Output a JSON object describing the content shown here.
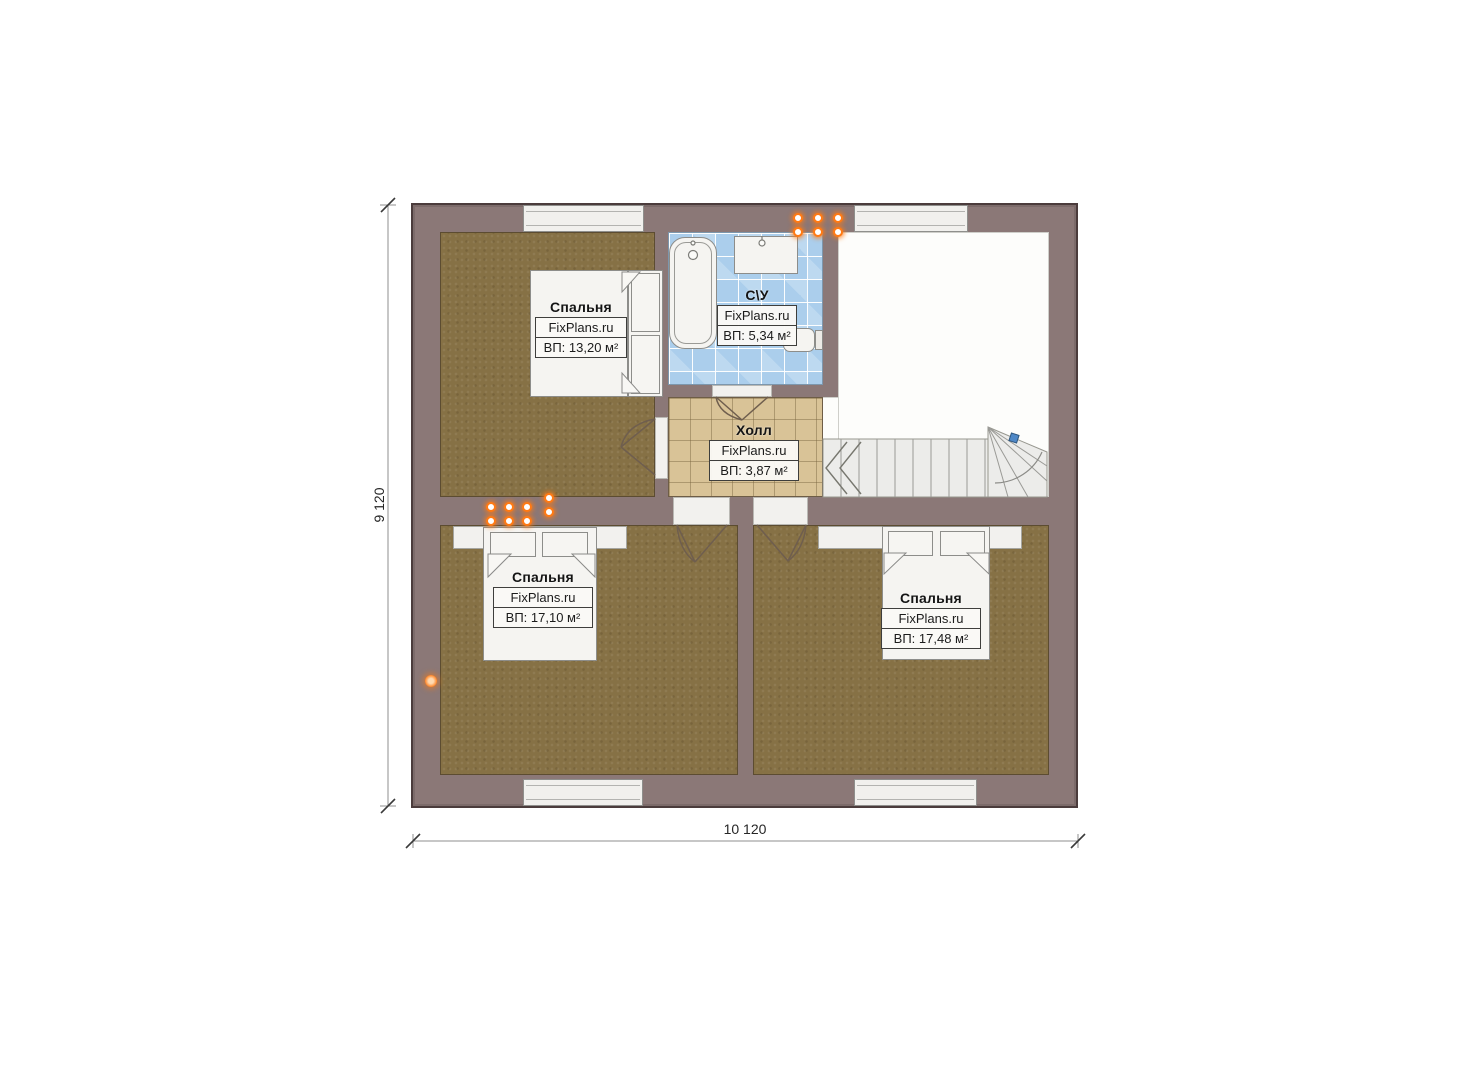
{
  "plan": {
    "dimensions": {
      "height_label": "9 120",
      "width_label": "10 120"
    },
    "rooms": {
      "bedroom_top_left": {
        "name": "Спальня",
        "brand": "FixPlans.ru",
        "area": "ВП: 13,20 м²"
      },
      "bathroom": {
        "name": "С\\У",
        "brand": "FixPlans.ru",
        "area": "ВП: 5,34 м²"
      },
      "hall": {
        "name": "Холл",
        "brand": "FixPlans.ru",
        "area": "ВП: 3,87 м²"
      },
      "bedroom_bottom_left": {
        "name": "Спальня",
        "brand": "FixPlans.ru",
        "area": "ВП: 17,10 м²"
      },
      "bedroom_bottom_right": {
        "name": "Спальня",
        "brand": "FixPlans.ru",
        "area": "ВП: 17,48 м²"
      }
    },
    "colors": {
      "wall": "#8b7877",
      "bedroom_floor": "#867145",
      "hall_tile": "#d9c397",
      "bath_tile": "#abceec",
      "socket_orange": "#ff7a14",
      "handle_blue": "#4f88c7"
    }
  }
}
